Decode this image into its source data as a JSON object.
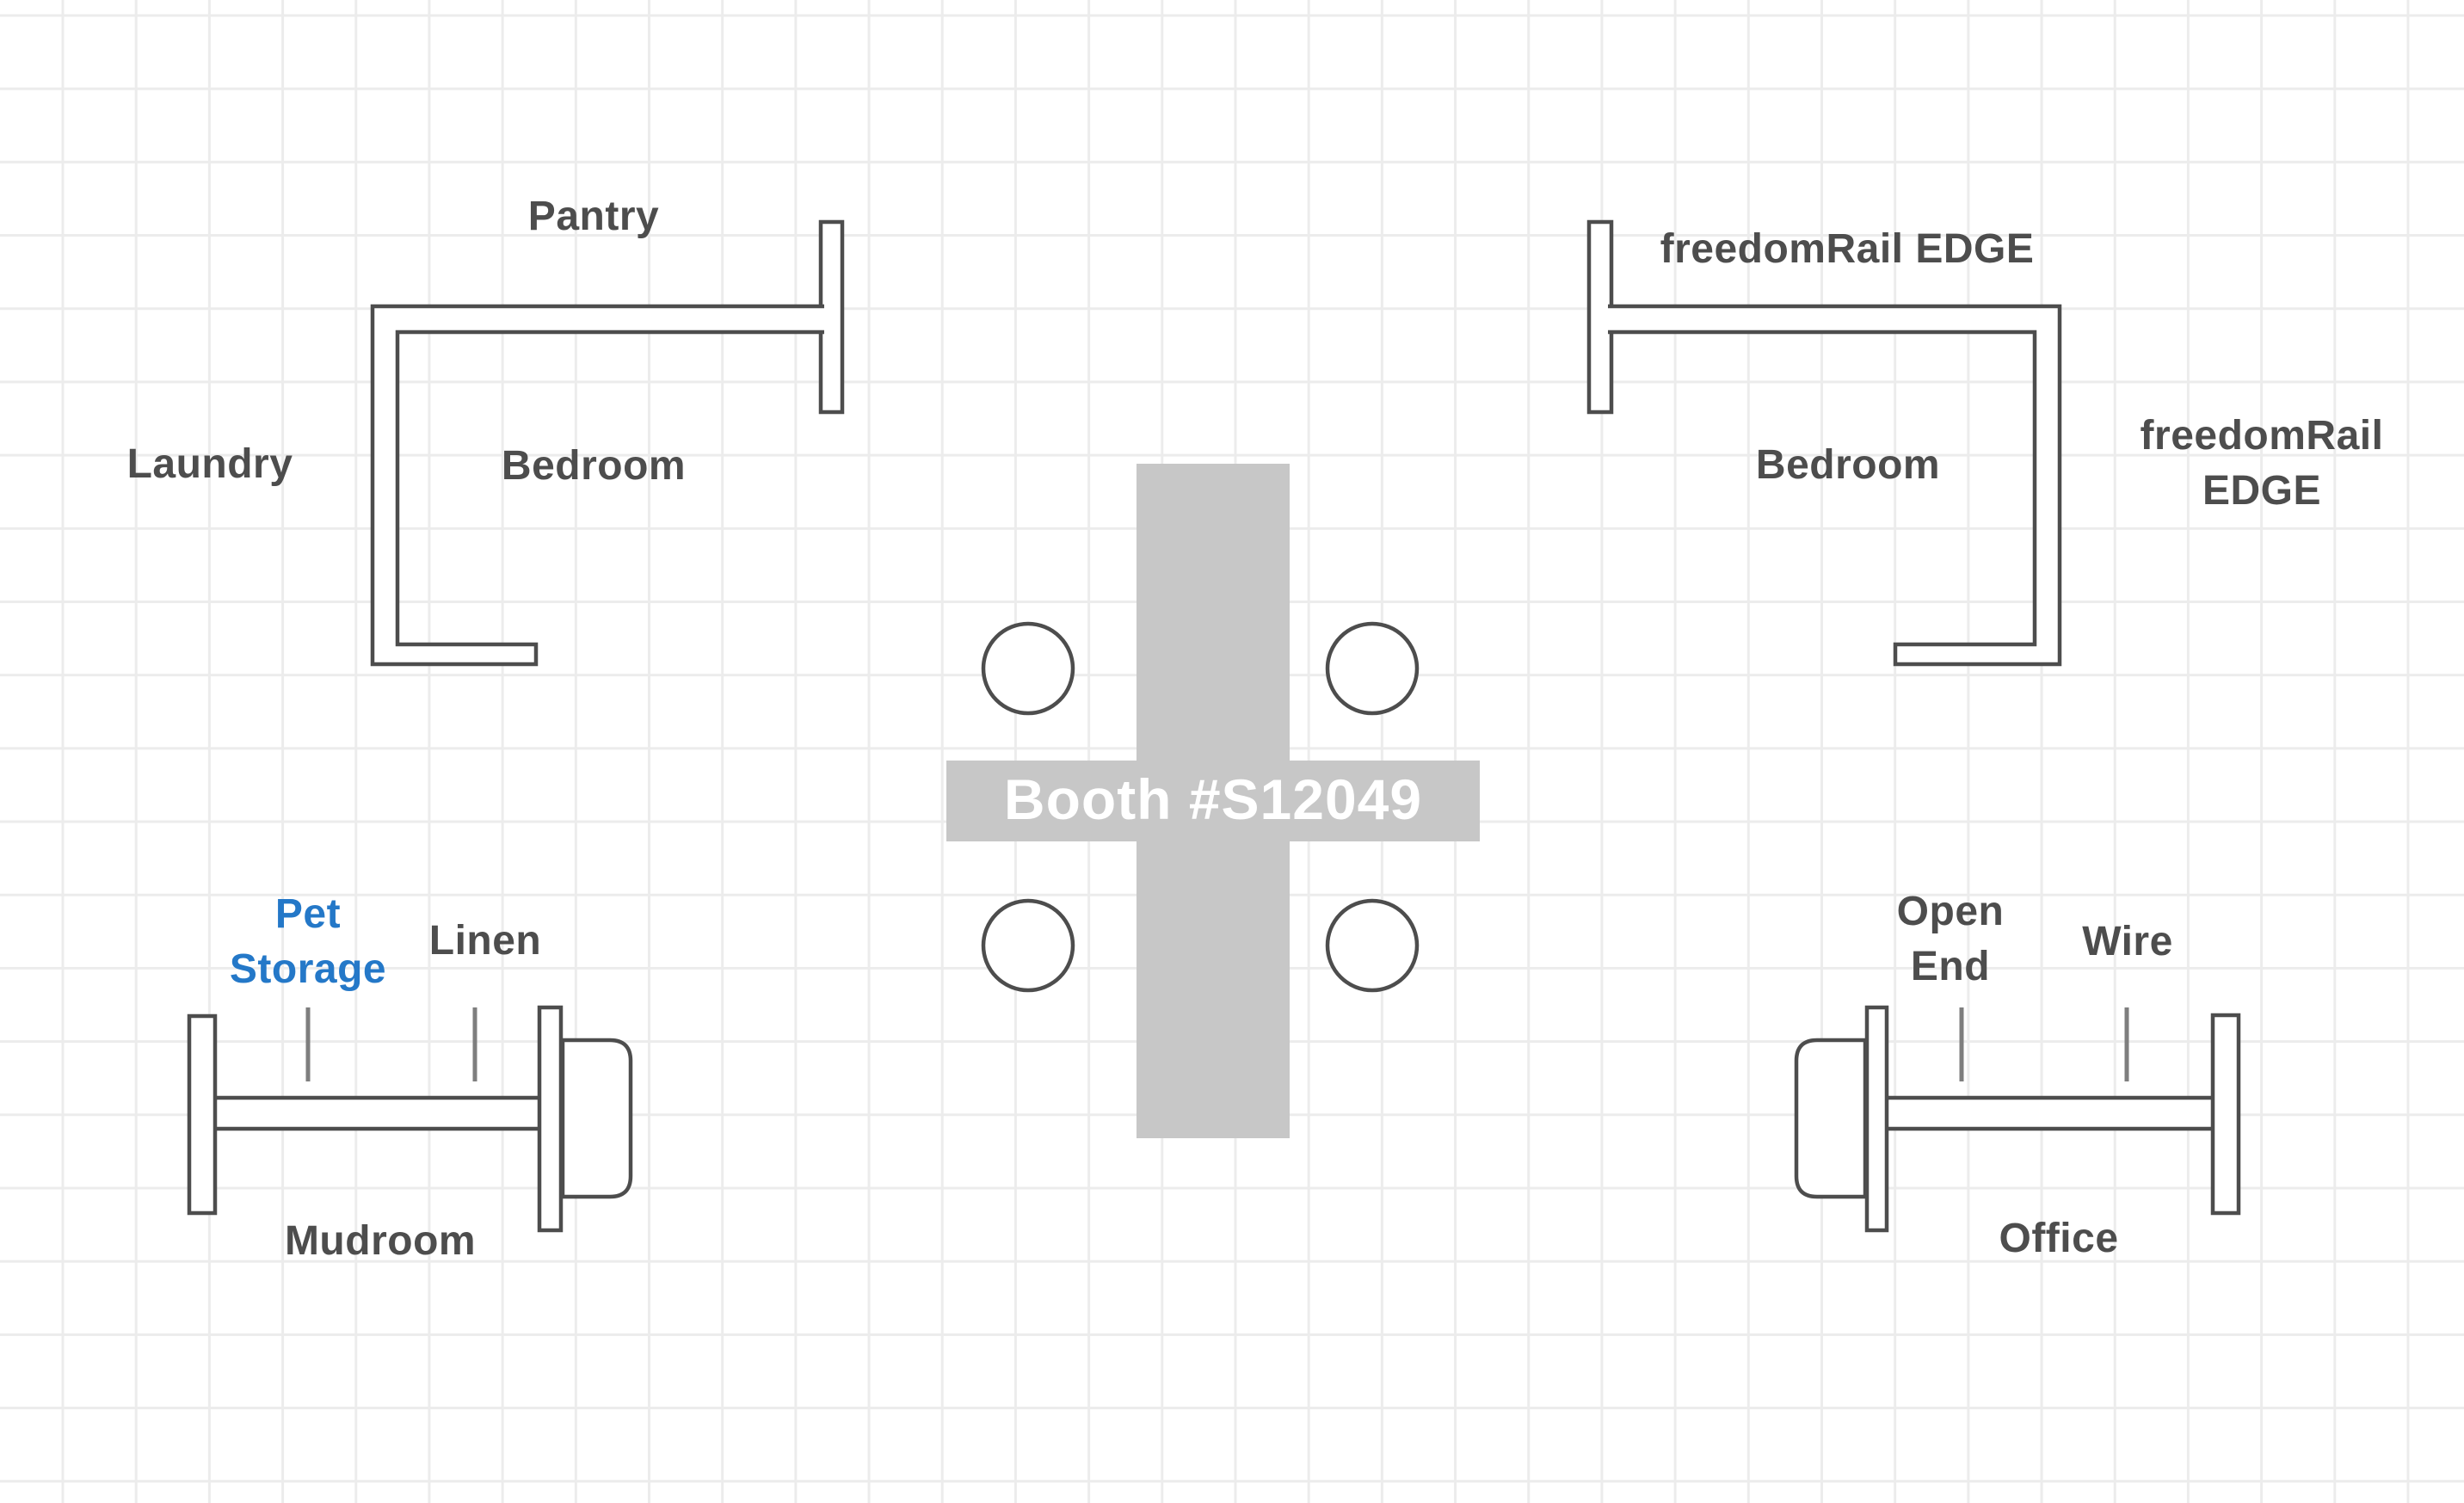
{
  "colors": {
    "background": "#ffffff",
    "grid_line": "#ececec",
    "wall_outline": "#4d4d4d",
    "label_text": "#4d4d4d",
    "accessory_tick": "#7e7e7e",
    "accent_blue": "#2478c8",
    "booth_fill": "#c7c7c7",
    "booth_text": "#ffffff"
  },
  "booth": {
    "label": "Booth #S12049"
  },
  "closets": {
    "top_left": {
      "top_label": "Pantry",
      "side_label": "Laundry",
      "room_label": "Bedroom"
    },
    "top_right": {
      "top_label": "freedomRail EDGE",
      "side_label": "freedomRail EDGE",
      "room_label": "Bedroom"
    }
  },
  "units": {
    "bottom_left": {
      "accessory_labels": [
        "Pet\nStorage",
        "Linen"
      ],
      "room_label": "Mudroom"
    },
    "bottom_right": {
      "accessory_labels": [
        "Open\nEnd",
        "Wire"
      ],
      "room_label": "Office"
    }
  }
}
